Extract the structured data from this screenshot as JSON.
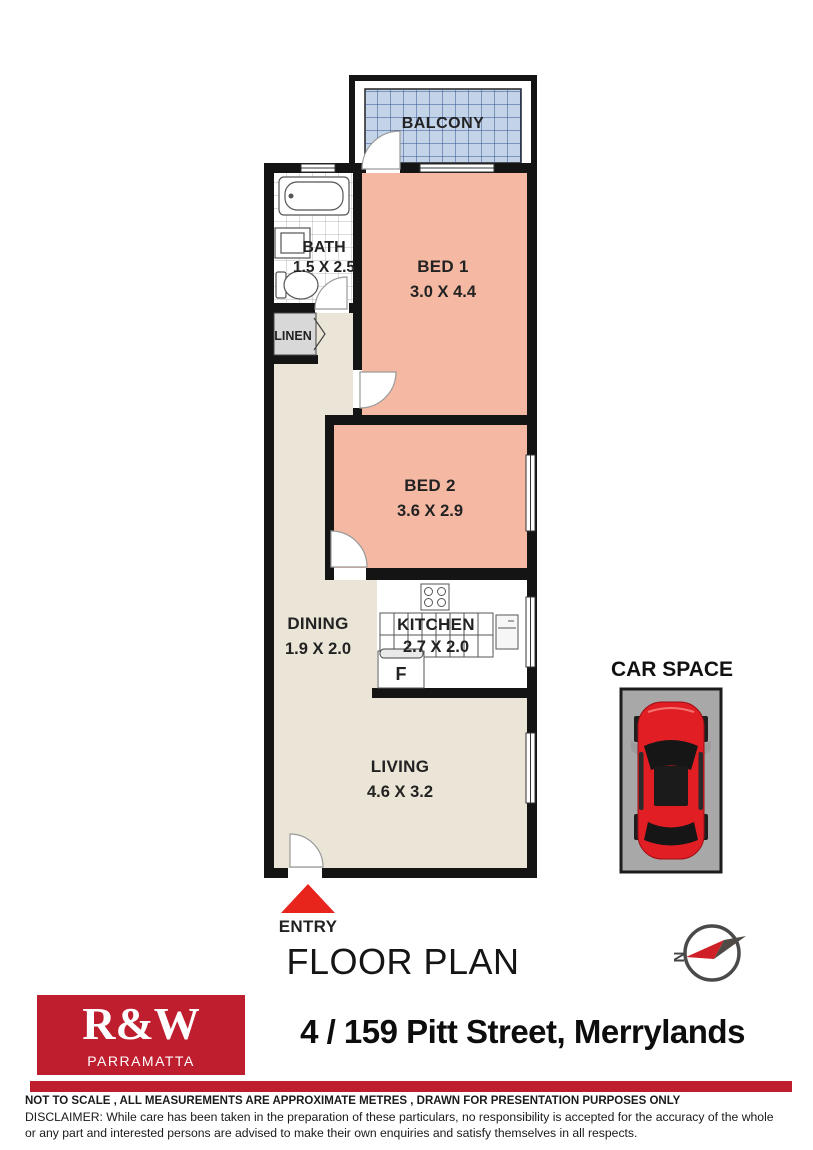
{
  "plan": {
    "balcony": {
      "label": "BALCONY"
    },
    "bath": {
      "label": "BATH",
      "dims": "1.5 X 2.5"
    },
    "bed1": {
      "label": "BED 1",
      "dims": "3.0 X 4.4"
    },
    "linen": {
      "label": "LINEN"
    },
    "bed2": {
      "label": "BED 2",
      "dims": "3.6 X 2.9"
    },
    "dining": {
      "label": "DINING",
      "dims": "1.9 X 2.0"
    },
    "kitchen": {
      "label": "KITCHEN",
      "dims": "2.7 X 2.0",
      "fridge_label": "F"
    },
    "living": {
      "label": "LIVING",
      "dims": "4.6 X 3.2"
    },
    "entry": {
      "label": "ENTRY"
    }
  },
  "car_space": {
    "label": "CAR SPACE"
  },
  "titles": {
    "floor_plan": "FLOOR PLAN"
  },
  "compass": {
    "north_label": "N"
  },
  "footer": {
    "logo": {
      "brand": "R&W",
      "office": "PARRAMATTA"
    },
    "address": "4 / 159 Pitt Street, Merrylands",
    "note": "NOT TO SCALE , ALL MEASUREMENTS ARE APPROXIMATE METRES , DRAWN FOR PRESENTATION PURPOSES ONLY",
    "disclaimer": "DISCLAIMER:  While care has been taken in the preparation of these particulars, no responsibility is accepted for the accuracy of the whole or any part and interested persons are advised to make their own enquiries and satisfy  themselves in all respects."
  },
  "colors": {
    "wall": "#141414",
    "bedroom": "#f5b9a3",
    "floor": "#eae5d6",
    "balcony": "#c3d3e8",
    "balcony_grid": "#33508c",
    "linen": "#d8d8d8",
    "carspace_gray": "#a8a8a8",
    "car_red": "#e01e24",
    "entry_red": "#e8251d",
    "brand_red": "#be1e2d"
  }
}
